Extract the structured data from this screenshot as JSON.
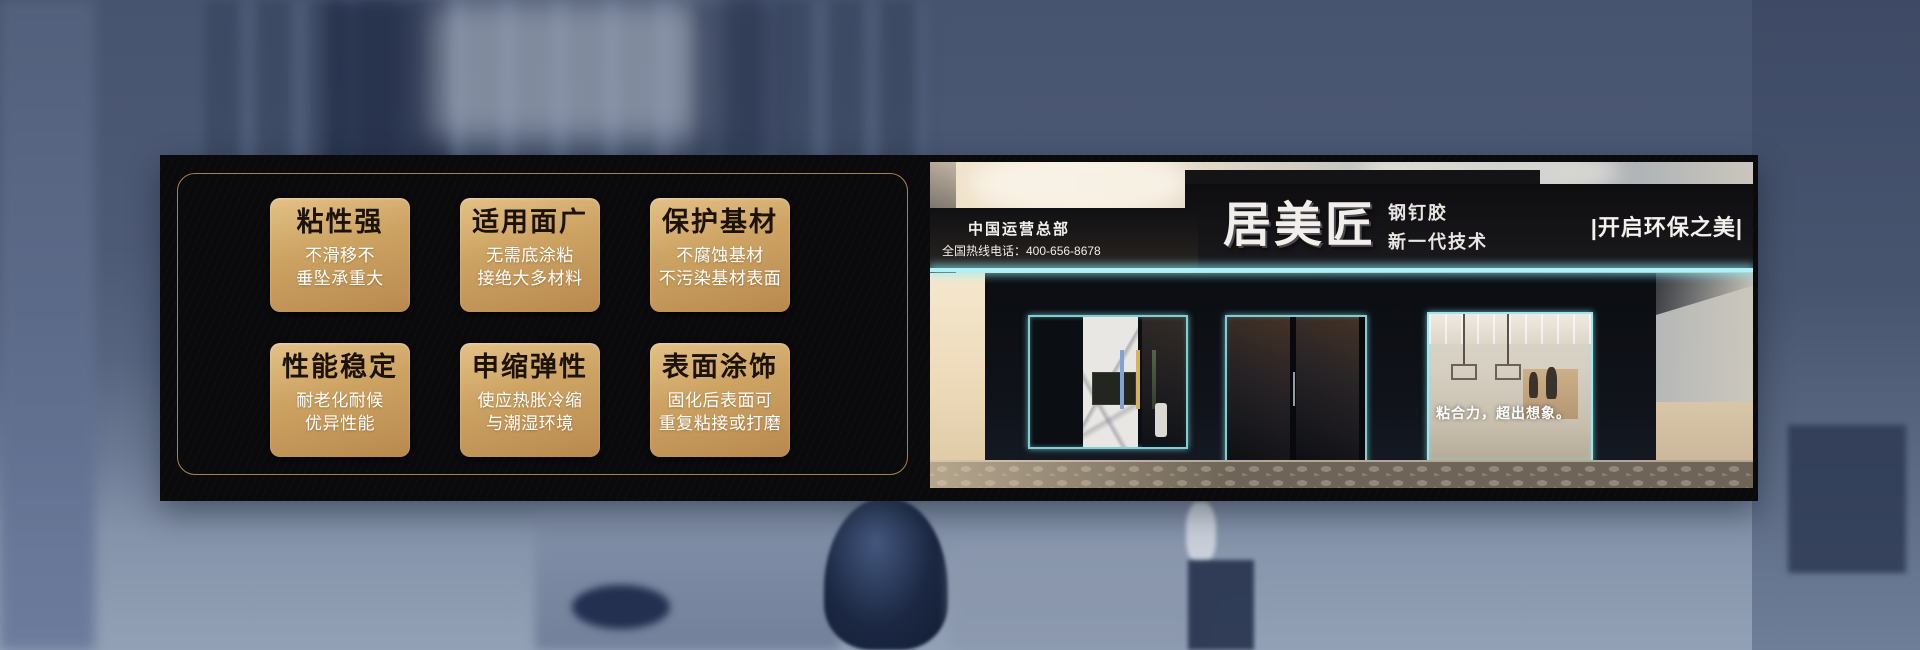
{
  "features": [
    {
      "title": "粘性强",
      "line1": "不滑移不",
      "line2": "垂坠承重大"
    },
    {
      "title": "适用面广",
      "line1": "无需底涂粘",
      "line2": "接绝大多材料"
    },
    {
      "title": "保护基材",
      "line1": "不腐蚀基材",
      "line2": "不污染基材表面"
    },
    {
      "title": "性能稳定",
      "line1": "耐老化耐候",
      "line2": "优异性能"
    },
    {
      "title": "申缩弹性",
      "line1": "使应热胀冷缩",
      "line2": "与潮湿环境"
    },
    {
      "title": "表面涂饰",
      "line1": "固化后表面可",
      "line2": "重复粘接或打磨"
    }
  ],
  "storefront": {
    "hq_label": "中国运营总部",
    "hotline": "全国热线电话：400-656-8678",
    "brand": "居美匠",
    "product": "钢钉胶",
    "tech": "新一代技术",
    "eco_slogan": "|开启环保之美|",
    "window_slogan": "粘合力，超出想象。"
  },
  "colors": {
    "gold-frame": "#b08a50",
    "card-gold-light": "#e3c187",
    "card-gold-mid": "#cda363",
    "card-gold-dark": "#b8894e",
    "card-title": "#1c1207",
    "neon": "#aef2f8",
    "banner-bg": "#0a0a0c",
    "sign-text": "#f2efeb",
    "scene-blue": "#51607c"
  }
}
